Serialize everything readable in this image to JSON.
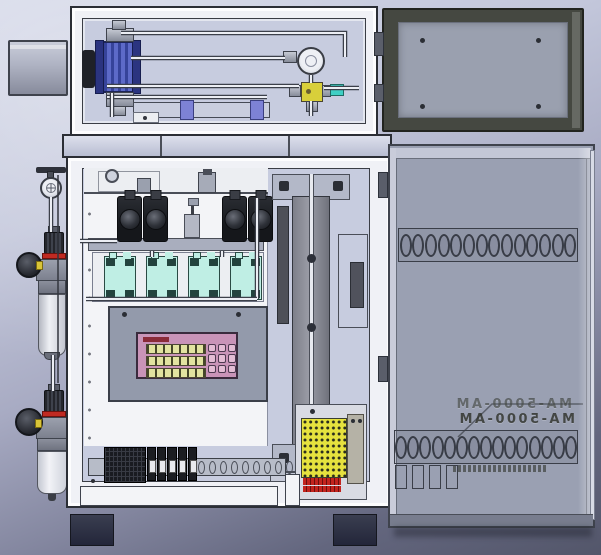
{
  "labels": {
    "door_model": "MA-5000-AM"
  },
  "colors": {
    "bg_top": "#d4d8e8",
    "bg_bottom": "#53566a",
    "frame_light": "#f0f1f6",
    "edge_dark": "#2b2e35",
    "interior": "#c7ccdf",
    "panel_white": "#f3f4f7",
    "door_top_frame": "#454841",
    "door_top_panel": "#9aa0af",
    "door_panel": "#9aa0b2",
    "door_edge_light": "#d8dbe6",
    "pump_blue": "#36439a",
    "pump_blue_dark": "#2b3480",
    "slide_purple": "#7d82d6",
    "brass_yellow": "#d8cf3a",
    "teal_fitting": "#3ecfc4",
    "sensor_teal": "#bfeee4",
    "sensor_dark": "#23433e",
    "control_plate": "#939aab",
    "panel_pink": "#c994b8",
    "panel_border": "#3a2b3d",
    "display_yellow": "#e2e3a0",
    "key_pink": "#e3bcd4",
    "title_red": "#8a2a38",
    "din_dark": "#191b20",
    "rail_gray": "#b7bcc8",
    "board_yellow": "#e6e23e",
    "conn_red": "#c3241e",
    "red_band": "#c02a22",
    "foot_dark": "#23263a",
    "pipe_light": "#eceef4",
    "pipe_dark": "#3c404a",
    "actuator_dark": "#4e5058"
  },
  "counts": {
    "upper_louver_holes": 14,
    "lower_louver_holes": 15,
    "keypad_keys": 9,
    "display_rows": 3,
    "regulators": 4,
    "sensor_blocks": 4,
    "relay_modules": 5,
    "rail_slots": 10,
    "door_slots": 4
  }
}
